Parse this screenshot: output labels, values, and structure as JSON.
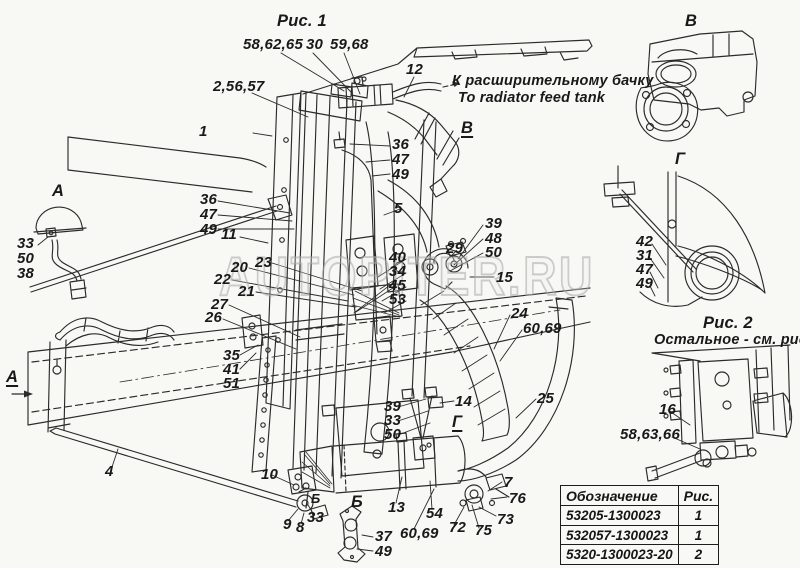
{
  "colors": {
    "background": "#f8f8f5",
    "line": "#2b2b2b",
    "text": "#191919",
    "watermark": "#a8a8a8"
  },
  "watermark": {
    "text": "AUTOPITER.RU"
  },
  "table": {
    "headers": [
      "Обозначение",
      "Рис."
    ],
    "rows": [
      {
        "code": "53205-1300023",
        "fig": "1"
      },
      {
        "code": "532057-1300023",
        "fig": "1"
      },
      {
        "code": "5320-1300023-20",
        "fig": "2"
      }
    ]
  },
  "callouts": [
    {
      "t": "Рис. 1",
      "x": 277,
      "y": 13,
      "cls": "fig-title",
      "n": "fig1-title"
    },
    {
      "t": "58,62,65",
      "x": 243,
      "y": 37
    },
    {
      "t": "30",
      "x": 306,
      "y": 37
    },
    {
      "t": "59,68",
      "x": 330,
      "y": 37
    },
    {
      "t": "2,56,57",
      "x": 213,
      "y": 79
    },
    {
      "t": "12",
      "x": 406,
      "y": 62
    },
    {
      "t": "К расширительному бачку",
      "x": 452,
      "y": 74,
      "cls": "note",
      "n": "note-expansion-tank-ru"
    },
    {
      "t": "To radiator feed tank",
      "x": 458,
      "y": 91,
      "cls": "note",
      "n": "note-expansion-tank-en"
    },
    {
      "t": "В",
      "x": 461,
      "y": 120,
      "cls": "sec u",
      "n": "section-label-v"
    },
    {
      "t": "1",
      "x": 199,
      "y": 124
    },
    {
      "t": "36",
      "x": 392,
      "y": 137
    },
    {
      "t": "47",
      "x": 392,
      "y": 152
    },
    {
      "t": "49",
      "x": 392,
      "y": 167
    },
    {
      "t": "5",
      "x": 394,
      "y": 201
    },
    {
      "t": "36",
      "x": 200,
      "y": 192
    },
    {
      "t": "47",
      "x": 200,
      "y": 207
    },
    {
      "t": "49",
      "x": 200,
      "y": 222
    },
    {
      "t": "11",
      "x": 221,
      "y": 227
    },
    {
      "t": "А",
      "x": 52,
      "y": 183,
      "cls": "sec",
      "n": "view-label-a"
    },
    {
      "t": "33",
      "x": 17,
      "y": 236
    },
    {
      "t": "50",
      "x": 17,
      "y": 251
    },
    {
      "t": "38",
      "x": 17,
      "y": 266
    },
    {
      "t": "20",
      "x": 231,
      "y": 260
    },
    {
      "t": "23",
      "x": 255,
      "y": 255
    },
    {
      "t": "22",
      "x": 214,
      "y": 272
    },
    {
      "t": "21",
      "x": 238,
      "y": 284
    },
    {
      "t": "27",
      "x": 211,
      "y": 297
    },
    {
      "t": "26",
      "x": 205,
      "y": 310
    },
    {
      "t": "40",
      "x": 389,
      "y": 250
    },
    {
      "t": "34",
      "x": 389,
      "y": 264
    },
    {
      "t": "45",
      "x": 389,
      "y": 278
    },
    {
      "t": "53",
      "x": 389,
      "y": 292
    },
    {
      "t": "29",
      "x": 446,
      "y": 241
    },
    {
      "t": "39",
      "x": 485,
      "y": 216
    },
    {
      "t": "48",
      "x": 485,
      "y": 231
    },
    {
      "t": "50",
      "x": 485,
      "y": 245
    },
    {
      "t": "15",
      "x": 496,
      "y": 270
    },
    {
      "t": "24",
      "x": 511,
      "y": 306
    },
    {
      "t": "60,69",
      "x": 523,
      "y": 321
    },
    {
      "t": "25",
      "x": 537,
      "y": 391
    },
    {
      "t": "35",
      "x": 223,
      "y": 348
    },
    {
      "t": "41",
      "x": 223,
      "y": 362
    },
    {
      "t": "51",
      "x": 223,
      "y": 376
    },
    {
      "t": "39",
      "x": 384,
      "y": 399
    },
    {
      "t": "33",
      "x": 384,
      "y": 413
    },
    {
      "t": "50",
      "x": 384,
      "y": 427
    },
    {
      "t": "14",
      "x": 455,
      "y": 394
    },
    {
      "t": "Г",
      "x": 452,
      "y": 414,
      "cls": "sec u",
      "n": "section-label-g"
    },
    {
      "t": "А",
      "x": 6,
      "y": 369,
      "cls": "sec u",
      "n": "section-label-a"
    },
    {
      "t": "4",
      "x": 105,
      "y": 464
    },
    {
      "t": "10",
      "x": 261,
      "y": 467
    },
    {
      "t": "9",
      "x": 283,
      "y": 517
    },
    {
      "t": "8",
      "x": 296,
      "y": 520
    },
    {
      "t": "33",
      "x": 307,
      "y": 510
    },
    {
      "t": "Б",
      "x": 311,
      "y": 492,
      "cls": "sec-sm",
      "n": "section-label-b"
    },
    {
      "t": "Б",
      "x": 351,
      "y": 494,
      "cls": "sec",
      "n": "view-label-b"
    },
    {
      "t": "13",
      "x": 388,
      "y": 500
    },
    {
      "t": "54",
      "x": 426,
      "y": 506
    },
    {
      "t": "60,69",
      "x": 400,
      "y": 526
    },
    {
      "t": "37",
      "x": 375,
      "y": 529
    },
    {
      "t": "49",
      "x": 375,
      "y": 544
    },
    {
      "t": "72",
      "x": 449,
      "y": 520
    },
    {
      "t": "75",
      "x": 475,
      "y": 523
    },
    {
      "t": "7",
      "x": 504,
      "y": 475
    },
    {
      "t": "76",
      "x": 509,
      "y": 491
    },
    {
      "t": "73",
      "x": 497,
      "y": 512
    },
    {
      "t": "В",
      "x": 685,
      "y": 13,
      "cls": "sec",
      "n": "view-label-v"
    },
    {
      "t": "Г",
      "x": 675,
      "y": 151,
      "cls": "sec",
      "n": "view-label-g"
    },
    {
      "t": "42",
      "x": 636,
      "y": 234
    },
    {
      "t": "31",
      "x": 636,
      "y": 248
    },
    {
      "t": "47",
      "x": 636,
      "y": 262
    },
    {
      "t": "49",
      "x": 636,
      "y": 276
    },
    {
      "t": "Рис. 2",
      "x": 703,
      "y": 315,
      "cls": "fig-title",
      "n": "fig2-title"
    },
    {
      "t": "Остальное - см. рис.1",
      "x": 654,
      "y": 333,
      "cls": "note",
      "n": "fig2-note"
    },
    {
      "t": "16",
      "x": 659,
      "y": 402
    },
    {
      "t": "58,63,66",
      "x": 620,
      "y": 427
    }
  ]
}
